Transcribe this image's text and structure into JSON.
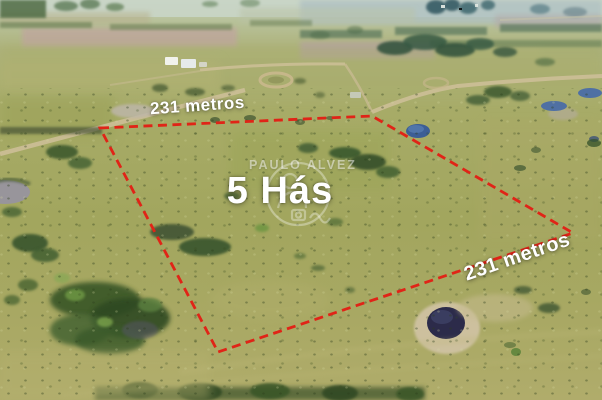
{
  "overlay": {
    "top_side": {
      "label": "231 metros"
    },
    "right_side": {
      "label": "231 metros"
    },
    "area": {
      "label": "5 Hás"
    },
    "watermark": {
      "name": "PAULO ALVEZ",
      "icon": "circular-photographer-logo"
    },
    "colors": {
      "boundary_red": "#e02417",
      "label_white": "#ffffff"
    }
  }
}
